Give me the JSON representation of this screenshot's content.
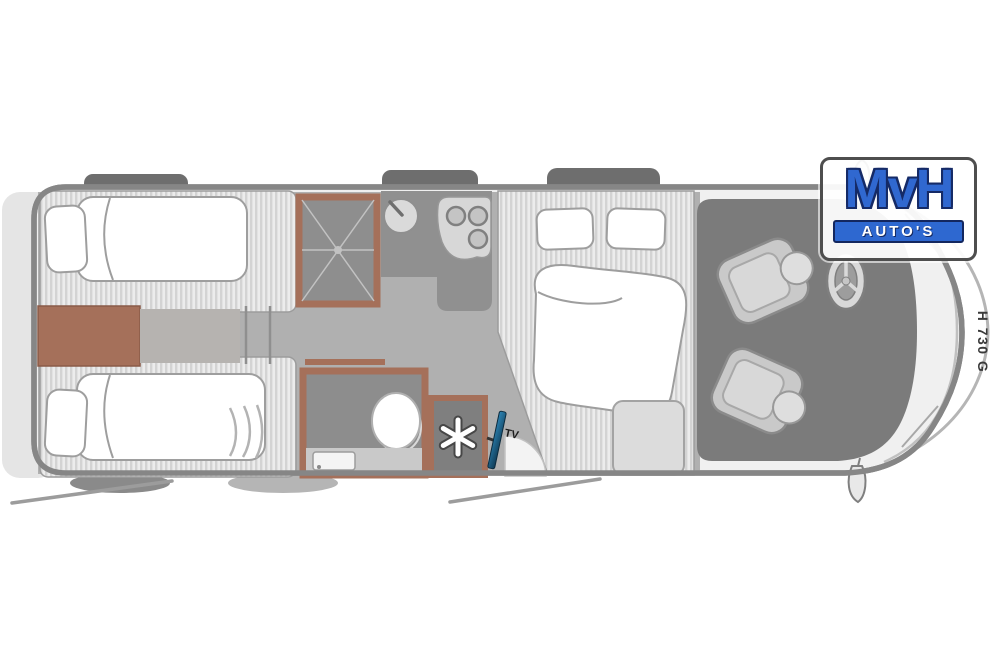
{
  "branding": {
    "logo_text": "MvH",
    "logo_subtext": "AUTO'S",
    "logo_text_color": "#3068d0",
    "logo_bar_color": "#2e68d0"
  },
  "vehicle": {
    "model_code": "H 730 G"
  },
  "labels": {
    "tv": "TV"
  },
  "colors": {
    "body_fill": "#f0f0f0",
    "body_outline": "#868686",
    "floor": "#b0b0b0",
    "lounge_floor": "#7b7b7b",
    "accent_brown": "#a5705a",
    "counter_gray": "#909090",
    "tv_blue": "#1e5f86",
    "upholstery_stripe_light": "#ececec",
    "upholstery_stripe_dark": "#d3d3d3"
  },
  "fixtures": [
    {
      "name": "rear-twin-bed-top",
      "icon": "bed-icon"
    },
    {
      "name": "rear-twin-bed-bottom",
      "icon": "bed-icon"
    },
    {
      "name": "rear-center-cabinet",
      "icon": "cabinet-icon"
    },
    {
      "name": "shower-cubicle",
      "icon": "shower-drain-icon"
    },
    {
      "name": "kitchen-sink",
      "icon": "sink-icon"
    },
    {
      "name": "kitchen-hob",
      "icon": "three-burner-icon"
    },
    {
      "name": "bathroom-toilet",
      "icon": "toilet-icon"
    },
    {
      "name": "bathroom-washbasin",
      "icon": "washbasin-icon"
    },
    {
      "name": "fridge",
      "icon": "snowflake-icon"
    },
    {
      "name": "tv-mount",
      "icon": "tv-icon"
    },
    {
      "name": "double-bed",
      "icon": "bed-icon"
    },
    {
      "name": "entry-door",
      "icon": "door-swing-icon"
    },
    {
      "name": "bench-seat",
      "icon": "seat-icon"
    },
    {
      "name": "cab-seat-driver",
      "icon": "swivel-seat-icon"
    },
    {
      "name": "cab-seat-passenger",
      "icon": "swivel-seat-icon"
    },
    {
      "name": "steering-wheel",
      "icon": "steering-wheel-icon"
    }
  ]
}
